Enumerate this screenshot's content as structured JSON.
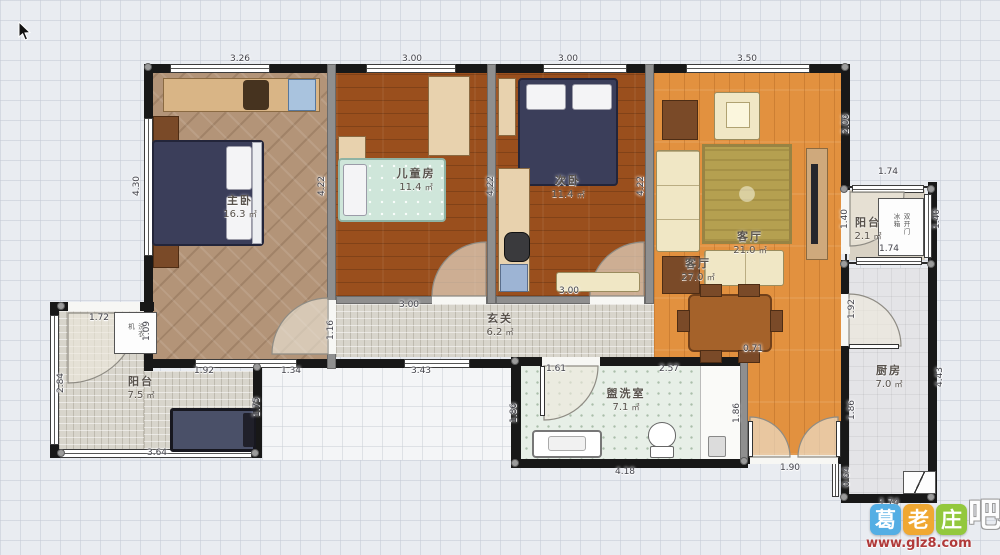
{
  "area_unit": "㎡",
  "rooms": [
    {
      "id": "master-bedroom",
      "name": "主卧",
      "area": "16.3",
      "x": 240,
      "y": 192
    },
    {
      "id": "children-room",
      "name": "儿童房",
      "area": "11.4",
      "x": 416,
      "y": 165
    },
    {
      "id": "second-bedroom",
      "name": "次卧",
      "area": "11.4",
      "x": 568,
      "y": 172
    },
    {
      "id": "living-room-inner",
      "name": "客厅",
      "area": "21.0",
      "x": 750,
      "y": 228
    },
    {
      "id": "living-room",
      "name": "客厅",
      "area": "27.0",
      "x": 698,
      "y": 255
    },
    {
      "id": "hallway",
      "name": "玄关",
      "area": "6.2",
      "x": 500,
      "y": 310
    },
    {
      "id": "washroom",
      "name": "盥洗室",
      "area": "7.1",
      "x": 626,
      "y": 385
    },
    {
      "id": "kitchen",
      "name": "厨房",
      "area": "7.0",
      "x": 889,
      "y": 362
    },
    {
      "id": "balcony-left",
      "name": "阳台",
      "area": "7.5",
      "x": 141,
      "y": 373
    },
    {
      "id": "balcony-right",
      "name": "阳台",
      "area": "2.1",
      "x": 868,
      "y": 214
    }
  ],
  "dimensions": [
    {
      "t": "3.26",
      "x": 240,
      "y": 59
    },
    {
      "t": "3.00",
      "x": 412,
      "y": 59
    },
    {
      "t": "3.00",
      "x": 568,
      "y": 59
    },
    {
      "t": "3.50",
      "x": 747,
      "y": 59
    },
    {
      "t": "2.06",
      "x": 846,
      "y": 124,
      "v": 1
    },
    {
      "t": "4.30",
      "x": 137,
      "y": 186,
      "v": 1
    },
    {
      "t": "4.22",
      "x": 322,
      "y": 186,
      "v": 1
    },
    {
      "t": "4.22",
      "x": 491,
      "y": 186,
      "v": 1
    },
    {
      "t": "4.22",
      "x": 641,
      "y": 186,
      "v": 1
    },
    {
      "t": "3.00",
      "x": 409,
      "y": 305
    },
    {
      "t": "3.00",
      "x": 569,
      "y": 291
    },
    {
      "t": "1.16",
      "x": 331,
      "y": 330,
      "v": 1
    },
    {
      "t": "1.92",
      "x": 204,
      "y": 371
    },
    {
      "t": "1.34",
      "x": 291,
      "y": 371
    },
    {
      "t": "3.43",
      "x": 421,
      "y": 371
    },
    {
      "t": "1.72",
      "x": 99,
      "y": 318
    },
    {
      "t": "1.09",
      "x": 147,
      "y": 331,
      "v": 1
    },
    {
      "t": "2.84",
      "x": 61,
      "y": 383,
      "v": 1
    },
    {
      "t": "3.64",
      "x": 157,
      "y": 453
    },
    {
      "t": "1.75",
      "x": 257,
      "y": 407,
      "v": 1
    },
    {
      "t": "1.61",
      "x": 556,
      "y": 369
    },
    {
      "t": "2.57",
      "x": 669,
      "y": 369
    },
    {
      "t": "1.86",
      "x": 514,
      "y": 413,
      "v": 1
    },
    {
      "t": "1.86",
      "x": 737,
      "y": 413,
      "v": 1
    },
    {
      "t": "4.18",
      "x": 625,
      "y": 472
    },
    {
      "t": "1.92",
      "x": 852,
      "y": 309,
      "v": 1
    },
    {
      "t": "1.86",
      "x": 852,
      "y": 410,
      "v": 1
    },
    {
      "t": "0.64",
      "x": 847,
      "y": 477,
      "v": 1
    },
    {
      "t": "4.43",
      "x": 940,
      "y": 377,
      "v": 1
    },
    {
      "t": "1.74",
      "x": 889,
      "y": 503
    },
    {
      "t": "1.74",
      "x": 888,
      "y": 172
    },
    {
      "t": "1.74",
      "x": 889,
      "y": 249
    },
    {
      "t": "1.40",
      "x": 845,
      "y": 219,
      "v": 1
    },
    {
      "t": "1.40",
      "x": 937,
      "y": 219,
      "v": 1
    },
    {
      "t": "1.90",
      "x": 790,
      "y": 468
    },
    {
      "t": "0.71",
      "x": 753,
      "y": 349
    }
  ],
  "appliances": {
    "fridge": "双开门冰箱",
    "washer": "洗衣机"
  },
  "watermark": {
    "tiles": [
      {
        "char": "葛",
        "color": "#54aee4"
      },
      {
        "char": "老",
        "color": "#f0a832"
      },
      {
        "char": "庄",
        "color": "#93c83d"
      }
    ],
    "suffix": "吧",
    "url": "www.glz8.com",
    "url_color": "#b03a3a"
  }
}
